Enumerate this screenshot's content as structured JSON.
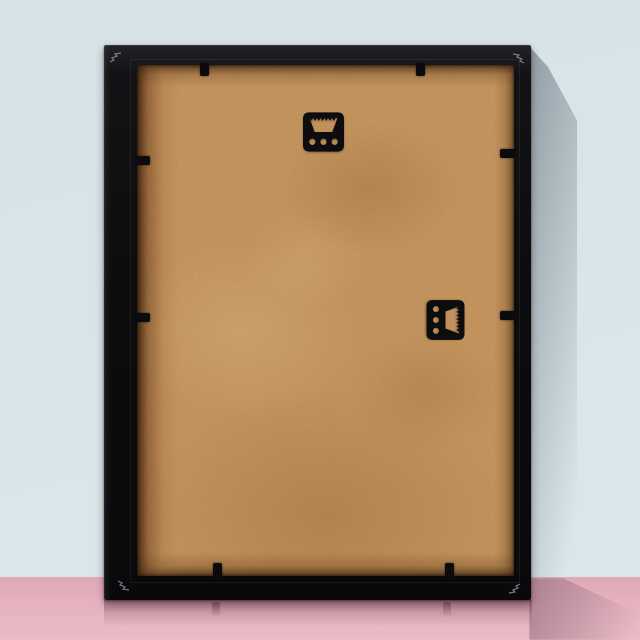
{
  "title": "Back view of a black picture frame leaning against a light blue wall on a pink floor",
  "colors": {
    "wall": "#d6e2e7",
    "wall2": "#dae6e9",
    "floor": "#dfa8b7",
    "floor-sheen": "#edbcc8",
    "frame": "#0c0c0e",
    "backing": "#c6965e",
    "hardware": "#0b0b0d"
  },
  "objects": {
    "frame": {
      "label": "black wooden picture frame, back side",
      "orientation": "portrait, leaning against wall"
    },
    "backing": {
      "label": "tan MDF hardboard backing panel"
    },
    "hangers": [
      {
        "label": "sawtooth hanger for portrait hanging",
        "position": "top center",
        "holes": 3
      },
      {
        "label": "sawtooth hanger for landscape hanging",
        "position": "right middle",
        "holes": 3
      }
    ],
    "tabs": {
      "label": "black flexi points securing the backing",
      "count": 8
    },
    "shadows": {
      "wall": "soft gray shadow cast to the right on wall",
      "floor": "mauve shadow wedge on floor",
      "reflection": "faint reflection on glossy pink floor"
    }
  }
}
